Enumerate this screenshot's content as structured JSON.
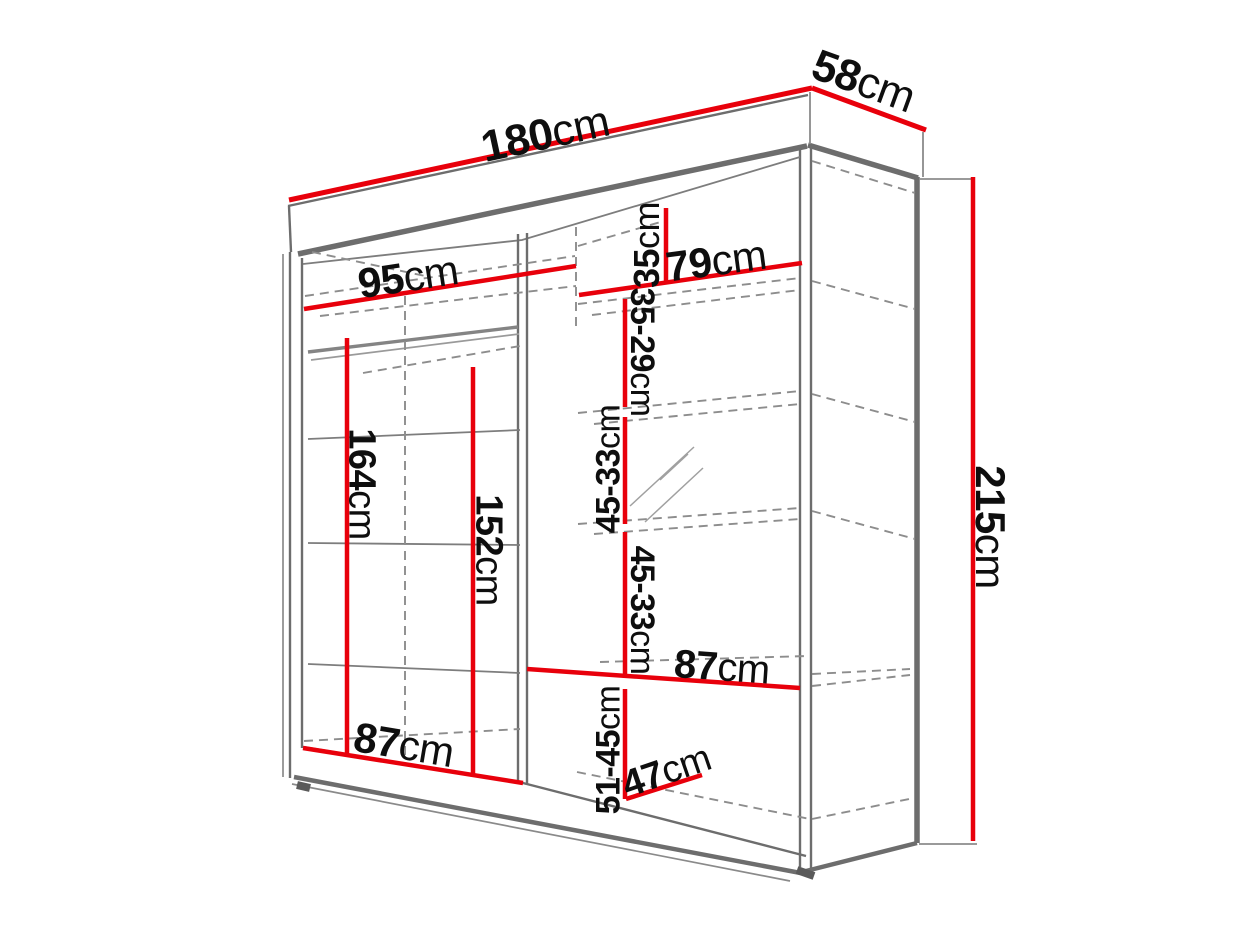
{
  "diagram": {
    "type": "furniture-dimension-drawing",
    "subject": "two-section sliding-door wardrobe shown in perspective with interior shelves and hanging rails"
  },
  "colors": {
    "dimension_line": "#e8000b",
    "structure_line": "#6d6d6d",
    "hidden_line": "#8d8d8d",
    "label_text": "#0e0e0e",
    "background": "#ffffff"
  },
  "dimensions": {
    "total_width": {
      "num": "180",
      "unit": "cm"
    },
    "total_depth": {
      "num": "58",
      "unit": "cm"
    },
    "total_height": {
      "num": "215",
      "unit": "cm"
    },
    "left_section_top_width": {
      "num": "95",
      "unit": "cm"
    },
    "right_shelf_width": {
      "num": "79",
      "unit": "cm"
    },
    "top_shelf_gap": {
      "num": "35",
      "unit": "cm"
    },
    "upper_shelf_gap": {
      "num": "35-29",
      "unit": "cm"
    },
    "middle_shelf_gap_1": {
      "num": "45-33",
      "unit": "cm"
    },
    "middle_shelf_gap_2": {
      "num": "45-33",
      "unit": "cm"
    },
    "lower_shelf_width": {
      "num": "87",
      "unit": "cm"
    },
    "bottom_shelf_gap": {
      "num": "51-45",
      "unit": "cm"
    },
    "bottom_depth": {
      "num": "47",
      "unit": "cm"
    },
    "left_bottom_width": {
      "num": "87",
      "unit": "cm"
    },
    "left_hanging_height": {
      "num": "164",
      "unit": "cm"
    },
    "right_hanging_height": {
      "num": "152",
      "unit": "cm"
    }
  }
}
